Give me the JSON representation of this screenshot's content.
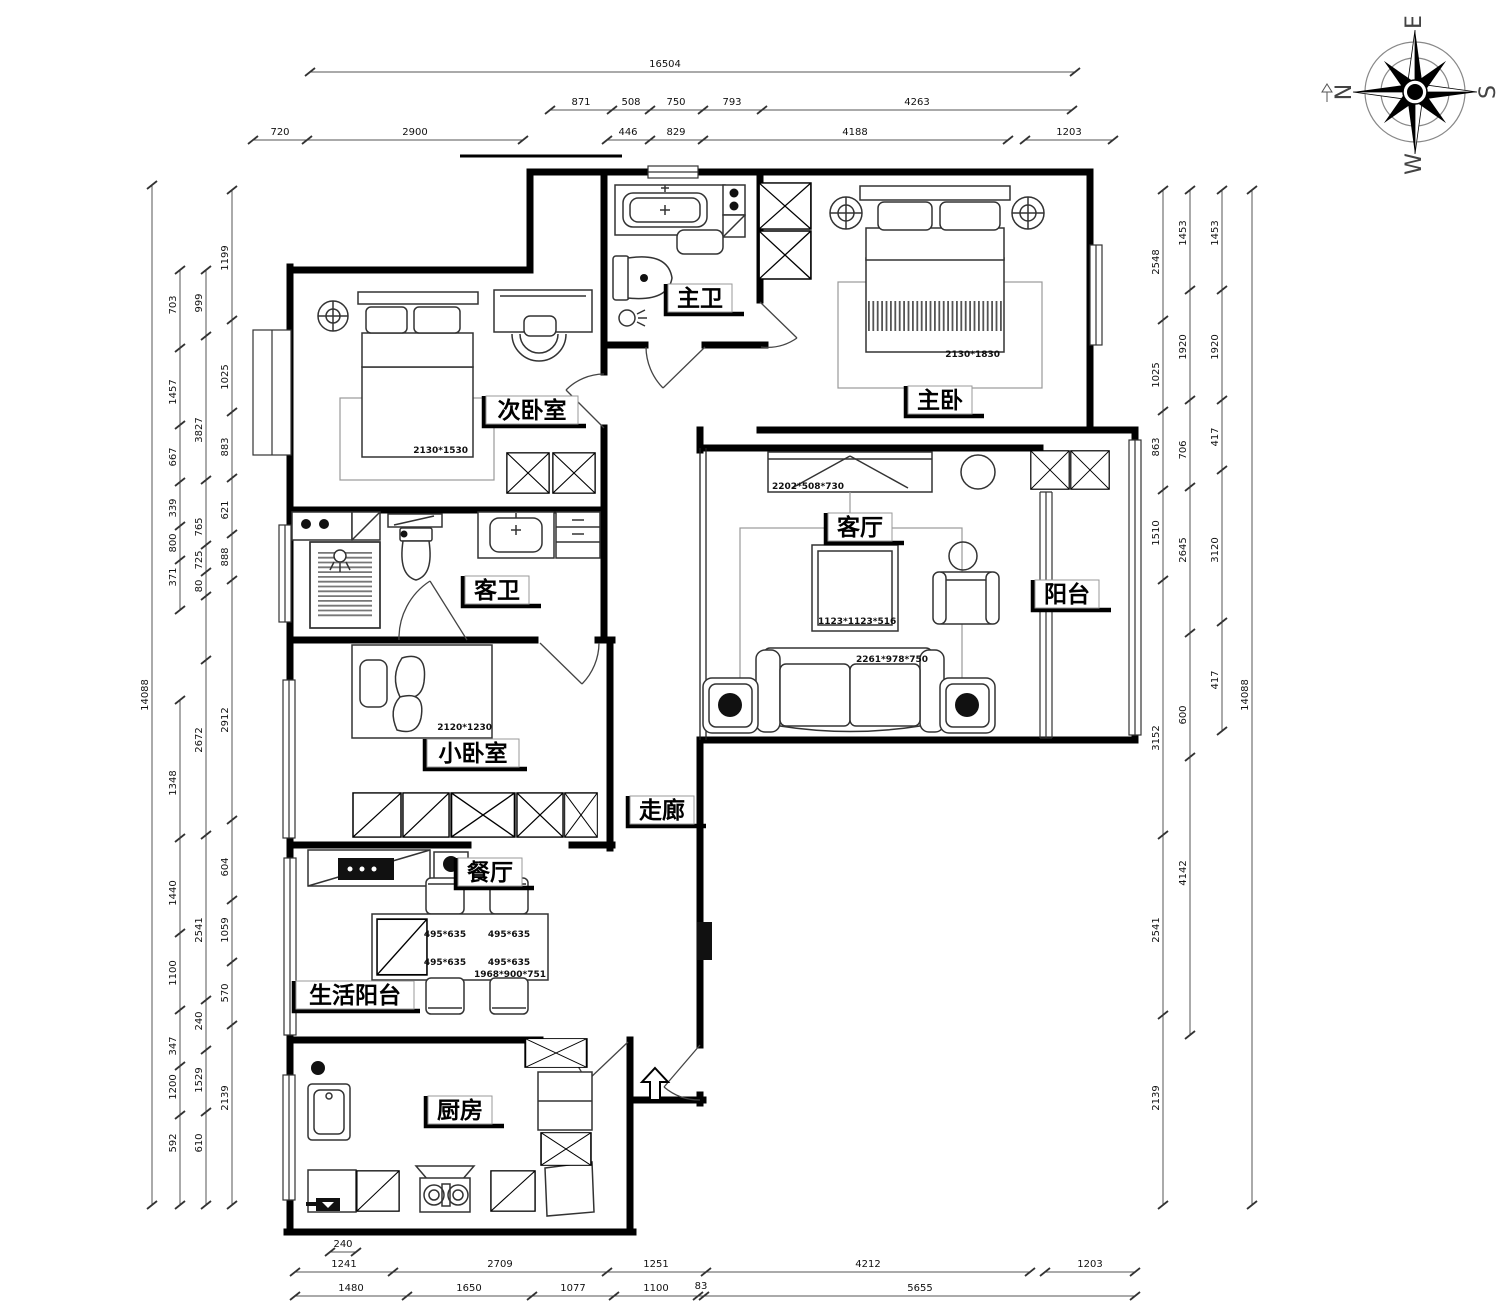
{
  "rooms": {
    "master_bath": "主卫",
    "master_bedroom": "主卧",
    "second_bedroom": "次卧室",
    "guest_bath": "客卫",
    "living_room": "客厅",
    "balcony": "阳台",
    "small_bedroom": "小卧室",
    "corridor": "走廊",
    "dining_room": "餐厅",
    "service_balcony": "生活阳台",
    "kitchen": "厨房"
  },
  "annotations": {
    "master_bed": "2130*1830",
    "secondary_bed": "2130*1530",
    "small_bed": "2120*1230",
    "tv_cabinet": "2202*508*730",
    "coffee_table": "1123*1123*516",
    "sofa": "2261*978*750",
    "dining_chair": "495*635",
    "dining_table": "1968*900*751"
  },
  "dimensions": {
    "top_overall": [
      "16504"
    ],
    "top_row2": [
      "871",
      "508",
      "750",
      "793",
      "4263"
    ],
    "top_row3": [
      "720",
      "2900",
      "446",
      "829",
      "4188",
      "1203"
    ],
    "bottom_small": [
      "240"
    ],
    "bottom_row1": [
      "1241",
      "2709",
      "1251",
      "4212",
      "1203"
    ],
    "bottom_row2": [
      "1480",
      "1650",
      "1077",
      "1100",
      "83",
      "5655"
    ],
    "left_outer": [
      "14088"
    ],
    "left_chain2": [
      "703",
      "1457",
      "667",
      "339",
      "800",
      "371",
      "1348",
      "1440",
      "1100",
      "347",
      "1200",
      "592"
    ],
    "left_chain3": [
      "999",
      "3827",
      "765",
      "725",
      "80",
      "2672",
      "2541",
      "240",
      "1529",
      "610"
    ],
    "left_chain4": [
      "1199",
      "1025",
      "883",
      "621",
      "888",
      "2912",
      "604",
      "1059",
      "570",
      "2139"
    ],
    "right_chain1": [
      "2548",
      "1025",
      "863",
      "1510",
      "3152",
      "2541",
      "2139"
    ],
    "right_chain2": [
      "1453",
      "1920",
      "706",
      "2645",
      "600",
      "4142"
    ],
    "right_chain3": [
      "1453",
      "1920",
      "417",
      "3120",
      "417"
    ],
    "right_outer": [
      "14088"
    ]
  },
  "compass": {
    "n": "N",
    "e": "E",
    "s": "S",
    "w": "W"
  }
}
